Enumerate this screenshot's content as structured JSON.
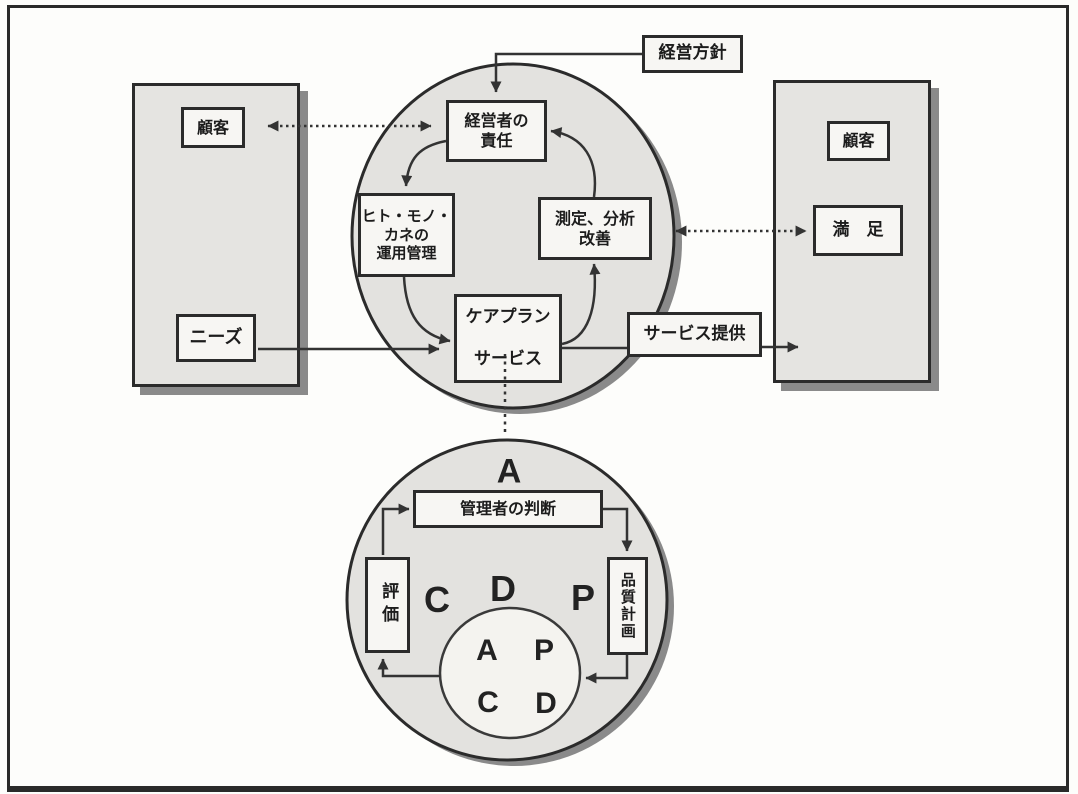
{
  "diagram": {
    "title_hint": "service quality management PDCA diagram",
    "boxes": {
      "policy": "経営方針",
      "customer_left": "顧客",
      "needs": "ニーズ",
      "customer_right": "顧客",
      "satisfaction": "満　足",
      "service_delivery": "サービス提供",
      "management_responsibility": {
        "line1": "経営者の",
        "line2": "責任"
      },
      "resources": {
        "line1": "ヒト・モノ・",
        "line2": "カネの",
        "line3": "運用管理"
      },
      "measurement": {
        "line1": "測定、分析",
        "line2": "改善"
      },
      "careplan": {
        "line1": "ケアプラン",
        "line2": "サービス"
      },
      "manager_judgment": "管理者の判断",
      "evaluation": "評価",
      "quality_plan": "品質計画"
    },
    "letters": {
      "act_top": "A",
      "check": "C",
      "do": "D",
      "plan": "P",
      "inner_a": "A",
      "inner_p": "P",
      "inner_c": "C",
      "inner_d": "D"
    },
    "colors": {
      "panel_fill": "#e5e4e1",
      "circle_fill": "#e3e2df",
      "inner_circle_fill": "#f4f3ef",
      "box_fill": "#f7f6f3",
      "border": "#2b2b2b",
      "arrow": "#333333",
      "shadow": "#8a8a8a",
      "background": "#fdfdfb"
    }
  }
}
